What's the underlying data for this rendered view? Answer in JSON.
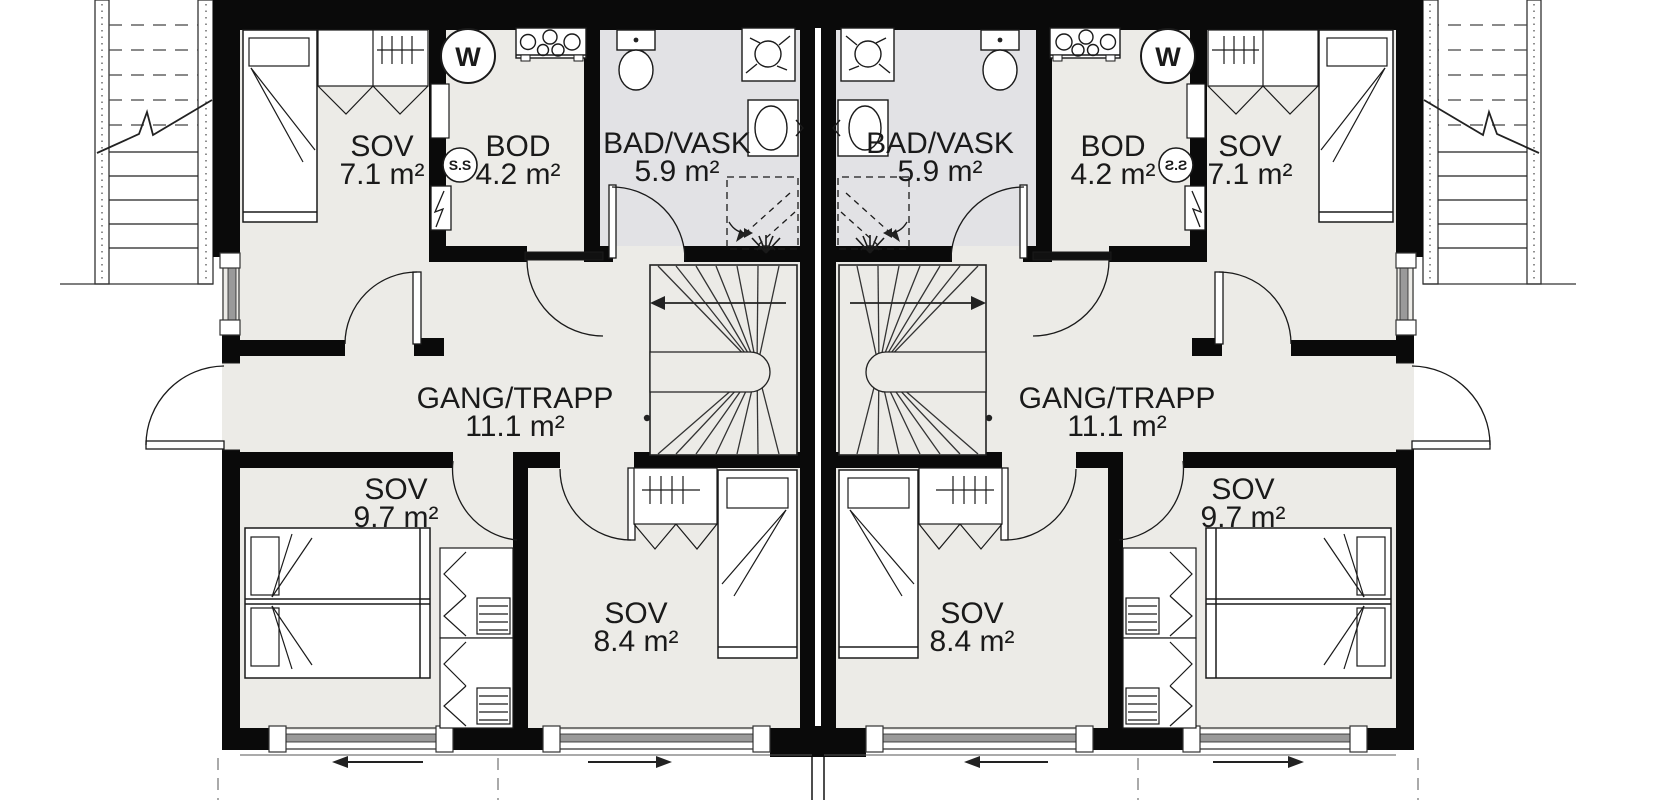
{
  "plan": {
    "type": "floor-plan",
    "colors": {
      "wall": "#0a0a0a",
      "floor": "#ECEBE7",
      "bathroom_floor": "#E2E2E5",
      "line": "#1a1a1a",
      "glazing": "#9a9a9a"
    },
    "units": [
      {
        "side": "left",
        "rooms": {
          "sov_top": {
            "name": "SOV",
            "area": "7.1 m²"
          },
          "bod": {
            "name": "BOD",
            "area": "4.2 m²"
          },
          "bad_vask": {
            "name": "BAD/VASK",
            "area": "5.9 m²"
          },
          "gang": {
            "name": "GANG/TRAPP",
            "area": "11.1 m²"
          },
          "sov_front": {
            "name": "SOV",
            "area": "9.7 m²"
          },
          "sov_mid": {
            "name": "SOV",
            "area": "8.4 m²"
          }
        }
      },
      {
        "side": "right",
        "rooms": {
          "sov_top": {
            "name": "SOV",
            "area": "7.1 m²"
          },
          "bod": {
            "name": "BOD",
            "area": "4.2 m²"
          },
          "bad_vask": {
            "name": "BAD/VASK",
            "area": "5.9 m²"
          },
          "gang": {
            "name": "GANG/TRAPP",
            "area": "11.1 m²"
          },
          "sov_front": {
            "name": "SOV",
            "area": "9.7 m²"
          },
          "sov_mid": {
            "name": "SOV",
            "area": "8.4 m²"
          }
        }
      }
    ],
    "symbols": {
      "washing_machine": "W",
      "fuse_cabinet": "S.S"
    }
  }
}
